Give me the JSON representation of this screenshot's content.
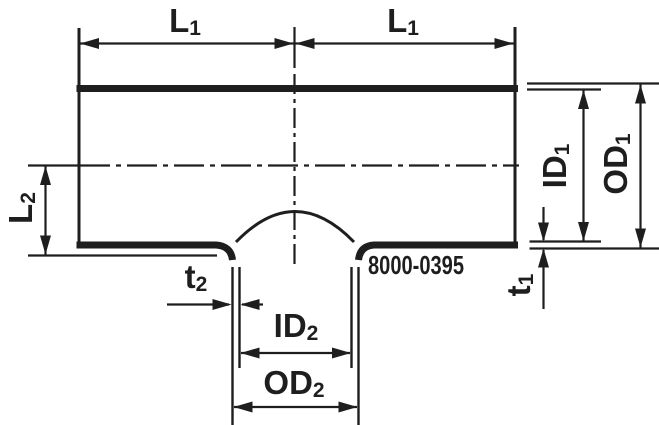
{
  "diagram": {
    "part_number": "8000-0395",
    "labels": {
      "l1_left": {
        "main": "L",
        "sub": "1"
      },
      "l1_right": {
        "main": "L",
        "sub": "1"
      },
      "l2": {
        "main": "L",
        "sub": "2"
      },
      "id1": {
        "main": "ID",
        "sub": "1"
      },
      "od1": {
        "main": "OD",
        "sub": "1"
      },
      "t1": {
        "main": "t",
        "sub": "1"
      },
      "t2": {
        "main": "t",
        "sub": "2"
      },
      "id2": {
        "main": "ID",
        "sub": "2"
      },
      "od2": {
        "main": "OD",
        "sub": "2"
      }
    },
    "colors": {
      "line": "#1e1e1e",
      "background": "#ffffff"
    }
  }
}
